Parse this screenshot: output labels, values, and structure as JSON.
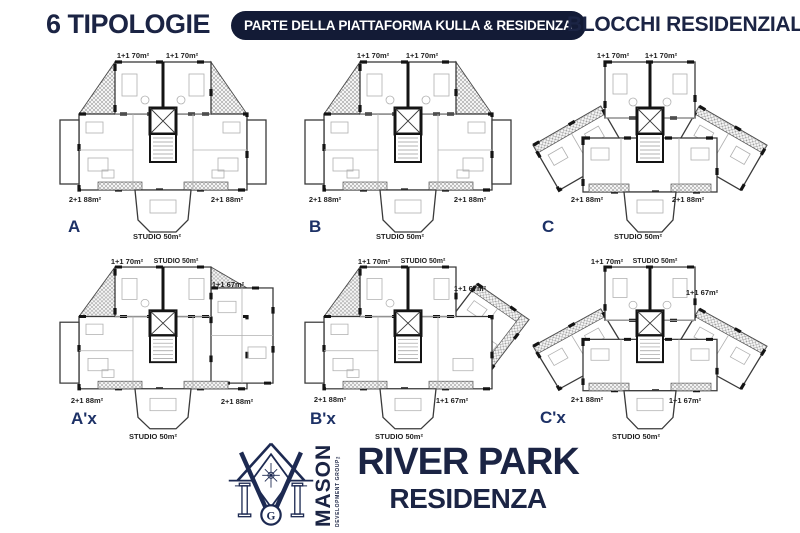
{
  "header": {
    "left_title": "6 TIPOLOGIE",
    "center_pill": "PARTE DELLA PIATTAFORMA KULLA & RESIDENZA",
    "right_title": "BLOCCHI RESIDENZIALI"
  },
  "plans": [
    {
      "letter": "A",
      "top_left": "1+1 70m²",
      "top_right": "1+1 70m²",
      "bottom_left": "2+1 88m²",
      "bottom_right": "2+1 88m²",
      "bottom_center": "STUDIO 50m²"
    },
    {
      "letter": "B",
      "top_left": "1+1 70m²",
      "top_right": "1+1 70m²",
      "bottom_left": "2+1 88m²",
      "bottom_right": "2+1 88m²",
      "bottom_center": "STUDIO 50m²"
    },
    {
      "letter": "C",
      "top_left": "1+1 70m²",
      "top_right": "1+1 70m²",
      "bottom_left": "2+1 88m²",
      "bottom_right": "2+1 88m²",
      "bottom_center": "STUDIO 50m²"
    },
    {
      "letter": "A'x",
      "top_left": "1+1 70m²",
      "top_center": "STUDIO 50m²",
      "side_right": "1+1 67m²",
      "bottom_left": "2+1 88m²",
      "bottom_right": "2+1 88m²",
      "bottom_center": "STUDIO 50m²"
    },
    {
      "letter": "B'x",
      "top_left": "1+1 70m²",
      "top_center": "STUDIO 50m²",
      "side_right": "1+1 67m²",
      "bottom_left": "2+1 88m²",
      "bottom_right": "1+1 67m²",
      "bottom_center": "STUDIO 50m²"
    },
    {
      "letter": "C'x",
      "top_left": "1+1 70m²",
      "top_center": "STUDIO 50m²",
      "side_right": "1+1 67m²",
      "bottom_left": "2+1 88m²",
      "bottom_right": "1+1 67m²",
      "bottom_center": "STUDIO 50m²"
    }
  ],
  "footer": {
    "brand": "MASON",
    "brand_sub": "DEVELOPMENT GROUP™",
    "logo_monogram": "G",
    "project_title": "RIVER PARK",
    "project_subtitle": "RESIDENZA"
  },
  "colors": {
    "navy": "#1b2444",
    "pill_bg": "#131b36",
    "ink": "#1f1f1f",
    "plan_letter": "#1d3166"
  }
}
